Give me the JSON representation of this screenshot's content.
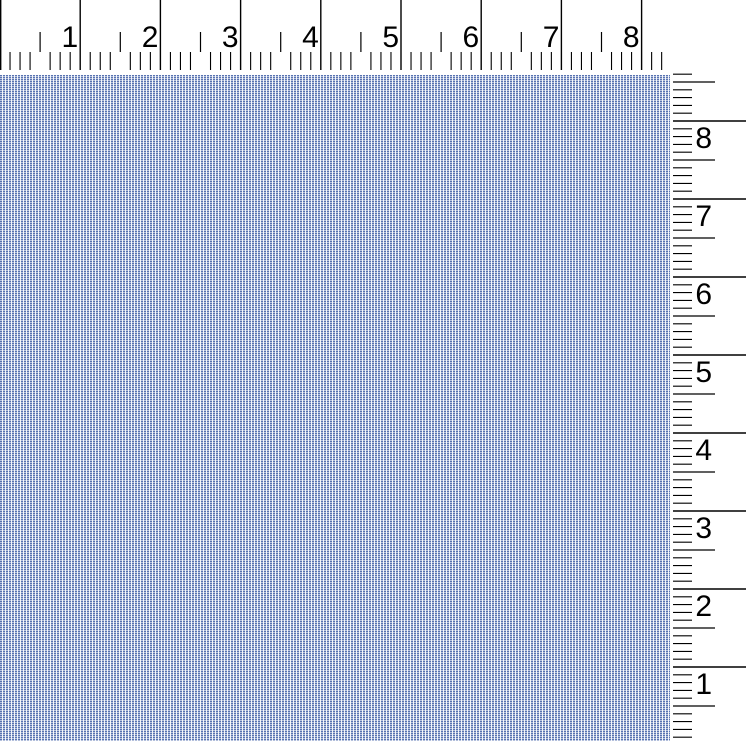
{
  "view": {
    "description": "Fabric swatch shown at actual size with inch rulers along the top and right edges",
    "background_color": "#ffffff"
  },
  "fabric": {
    "name": "light-blue-oxford-weave-fabric",
    "thread_color": "#5873b2",
    "ground_color": "#eef2f8",
    "average_color": "#aab9d6"
  },
  "top_ruler": {
    "unit": "inches",
    "labels": [
      "1",
      "2",
      "3",
      "4",
      "5",
      "6",
      "7",
      "8"
    ],
    "px_per_unit": 80.2,
    "minor_ticks_per_unit": 8,
    "length_px": 663,
    "tick_color": "#000000",
    "label_color": "#000000"
  },
  "right_ruler": {
    "unit": "inches",
    "labels_top_to_bottom": [
      "8",
      "7",
      "6",
      "5",
      "4",
      "3",
      "2",
      "1"
    ],
    "px_per_unit": 78,
    "minor_ticks_per_unit": 10,
    "tick_color": "#000000",
    "label_color": "#000000"
  }
}
